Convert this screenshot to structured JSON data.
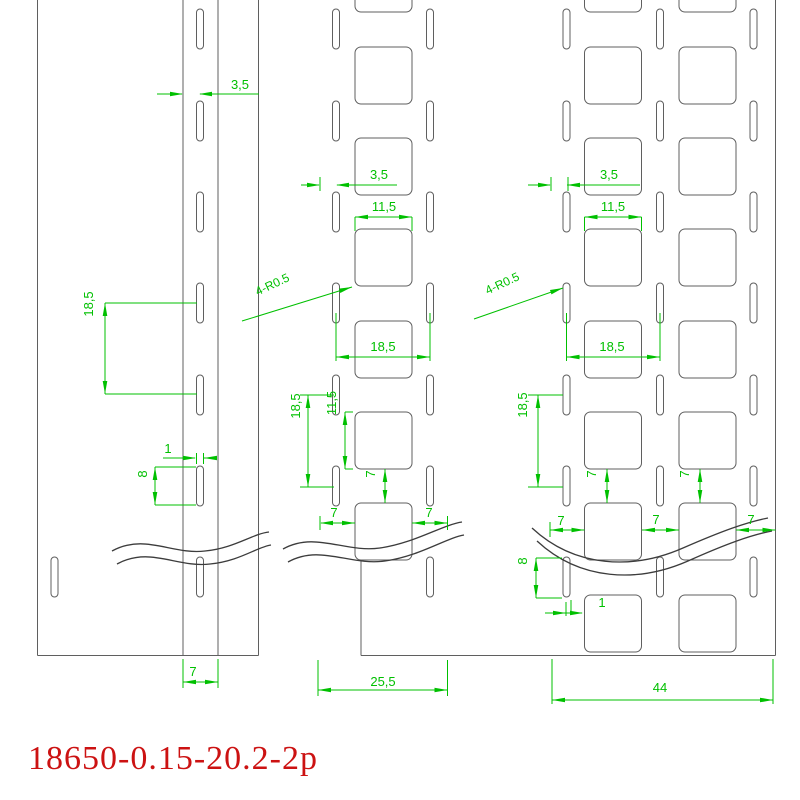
{
  "title": {
    "text": "18650-0.15-20.2-2p"
  },
  "colors": {
    "background": "#ffffff",
    "outline": "#5f5f5f",
    "wave": "#3c3c3c",
    "dimension": "#00c000",
    "title": "#cc1212"
  },
  "geometry": {
    "outline_lines": [
      [
        37.5,
        0,
        37.5,
        655.5
      ],
      [
        183,
        0,
        183,
        655.5
      ],
      [
        218,
        0,
        218,
        655.5
      ],
      [
        258.5,
        0,
        258.5,
        655.5
      ],
      [
        37.5,
        655.5,
        258.5,
        655.5
      ],
      [
        775.5,
        0,
        775.5,
        655.5
      ],
      [
        361,
        558,
        361,
        655.5
      ],
      [
        361,
        655.5,
        775.5,
        655.5
      ]
    ],
    "slot": {
      "w": 7,
      "h": 40,
      "rx": 3.5
    },
    "slot_columns": [
      {
        "x": 200,
        "centers": [
          29,
          121,
          212,
          303,
          395,
          486,
          577
        ]
      },
      {
        "x": 54.5,
        "centers": [
          577
        ]
      },
      {
        "x": 336,
        "centers": [
          29,
          121,
          212,
          303,
          395,
          486
        ]
      },
      {
        "x": 430,
        "centers": [
          29,
          121,
          212,
          303,
          395,
          486,
          577
        ]
      },
      {
        "x": 566.5,
        "centers": [
          29,
          121,
          212,
          303,
          395,
          486,
          577
        ]
      },
      {
        "x": 660,
        "centers": [
          29,
          121,
          212,
          303,
          395,
          486,
          577
        ]
      },
      {
        "x": 753.5,
        "centers": [
          29,
          121,
          212,
          303,
          395,
          486,
          577
        ]
      }
    ],
    "square": {
      "size": 57,
      "r": 6
    },
    "square_columns": [
      {
        "x": 355,
        "tops": [
          -45,
          47,
          138,
          229,
          321,
          412,
          503
        ]
      },
      {
        "x": 584.5,
        "tops": [
          -45,
          47,
          138,
          229,
          321,
          412,
          503,
          595
        ]
      },
      {
        "x": 679,
        "tops": [
          -45,
          47,
          138,
          229,
          321,
          412,
          503,
          595
        ]
      }
    ],
    "waves": [
      "M112,551 C145,533 172,555 205,551 C235,548 252,534 269,532",
      "M117,564 C150,546 177,568 210,564 C240,561 257,547 271,545",
      "M283,549 C315,531 345,553 380,548 C415,543 442,525 462,522",
      "M288,562 C320,544 350,566 385,561 C420,556 446,538 464,535",
      "M532,528 C575,568 633,570 683,548 C722,531 747,522 768,518",
      "M537,541 C580,581 638,583 688,561 C726,544 751,535 772,531"
    ]
  },
  "dimensions": {
    "lines": [
      [
        157,
        94,
        182,
        94
      ],
      [
        200,
        94,
        259,
        94
      ],
      [
        105,
        303,
        105,
        394
      ],
      [
        105,
        303,
        197,
        303
      ],
      [
        105,
        394,
        197,
        394
      ],
      [
        163,
        458,
        195,
        458
      ],
      [
        204,
        458,
        213,
        458
      ],
      [
        196.5,
        453,
        196.5,
        464
      ],
      [
        203.5,
        453,
        203.5,
        464
      ],
      [
        155,
        467,
        155,
        505
      ],
      [
        155,
        467,
        196,
        467
      ],
      [
        155,
        505,
        196,
        505
      ],
      [
        183,
        682,
        218,
        682
      ],
      [
        183,
        659,
        183,
        688
      ],
      [
        218,
        659,
        218,
        688
      ],
      [
        301,
        185,
        319,
        185
      ],
      [
        337,
        185,
        397,
        185
      ],
      [
        320,
        177,
        320,
        191
      ],
      [
        355,
        217,
        412,
        217
      ],
      [
        355,
        217,
        355,
        231
      ],
      [
        412,
        217,
        412,
        231
      ],
      [
        242,
        321,
        352,
        287
      ],
      [
        336,
        357,
        430,
        357
      ],
      [
        336,
        313,
        336,
        361
      ],
      [
        430,
        313,
        430,
        361
      ],
      [
        308,
        395,
        308,
        487
      ],
      [
        300,
        395,
        334,
        395
      ],
      [
        300,
        487,
        334,
        487
      ],
      [
        345,
        412,
        345,
        469
      ],
      [
        345,
        412,
        353,
        412
      ],
      [
        345,
        469,
        353,
        469
      ],
      [
        385,
        469,
        385,
        503
      ],
      [
        321,
        523,
        355,
        523
      ],
      [
        320,
        516,
        320,
        530
      ],
      [
        412,
        523,
        447,
        523
      ],
      [
        447.5,
        516,
        447.5,
        530
      ],
      [
        318,
        690,
        447.5,
        690
      ],
      [
        318,
        660,
        318,
        696
      ],
      [
        447.5,
        660,
        447.5,
        696
      ],
      [
        528,
        185,
        550,
        185
      ],
      [
        567,
        185,
        640,
        185
      ],
      [
        551,
        177,
        551,
        191
      ],
      [
        568,
        177,
        568,
        191
      ],
      [
        584.5,
        217,
        641.5,
        217
      ],
      [
        584.5,
        217,
        584.5,
        231
      ],
      [
        641.5,
        217,
        641.5,
        231
      ],
      [
        474,
        319,
        563,
        288
      ],
      [
        566.5,
        357,
        660,
        357
      ],
      [
        566.5,
        313,
        566.5,
        361
      ],
      [
        660,
        313,
        660,
        361
      ],
      [
        538,
        395,
        538,
        487
      ],
      [
        528,
        395,
        563,
        395
      ],
      [
        528,
        487,
        563,
        487
      ],
      [
        607,
        469,
        607,
        503
      ],
      [
        700,
        469,
        700,
        503
      ],
      [
        550,
        530,
        584.5,
        530
      ],
      [
        550,
        522,
        550,
        537
      ],
      [
        642,
        530,
        679,
        530
      ],
      [
        736,
        530,
        775.5,
        530
      ],
      [
        536,
        558,
        536,
        598
      ],
      [
        536,
        558,
        562,
        558
      ],
      [
        536,
        598,
        562,
        598
      ],
      [
        545,
        613,
        582,
        613
      ],
      [
        566,
        602,
        566,
        616
      ],
      [
        571,
        600,
        571,
        611
      ],
      [
        552,
        700,
        773,
        700
      ],
      [
        552,
        659,
        552,
        704
      ],
      [
        773,
        659,
        773,
        704
      ]
    ],
    "arrows": [
      [
        183,
        94,
        0
      ],
      [
        199,
        94,
        180
      ],
      [
        105,
        303,
        -90
      ],
      [
        105,
        394,
        90
      ],
      [
        196,
        458,
        0
      ],
      [
        204,
        458,
        180
      ],
      [
        155,
        467,
        -90
      ],
      [
        155,
        505,
        90
      ],
      [
        183,
        682,
        180
      ],
      [
        218,
        682,
        0
      ],
      [
        320,
        185,
        0
      ],
      [
        336,
        185,
        180
      ],
      [
        355,
        217,
        180
      ],
      [
        412,
        217,
        0
      ],
      [
        352,
        287,
        -17
      ],
      [
        336,
        357,
        180
      ],
      [
        430,
        357,
        0
      ],
      [
        308,
        395,
        -90
      ],
      [
        308,
        487,
        90
      ],
      [
        345,
        412,
        -90
      ],
      [
        345,
        469,
        90
      ],
      [
        385,
        469,
        -90
      ],
      [
        385,
        503,
        90
      ],
      [
        320,
        523,
        180
      ],
      [
        355,
        523,
        0
      ],
      [
        412,
        523,
        180
      ],
      [
        447.5,
        523,
        0
      ],
      [
        318,
        690,
        180
      ],
      [
        447.5,
        690,
        0
      ],
      [
        551,
        185,
        0
      ],
      [
        567,
        185,
        180
      ],
      [
        584.5,
        217,
        180
      ],
      [
        641.5,
        217,
        0
      ],
      [
        563,
        288,
        -19
      ],
      [
        566.5,
        357,
        180
      ],
      [
        660,
        357,
        0
      ],
      [
        538,
        395,
        -90
      ],
      [
        538,
        487,
        90
      ],
      [
        607,
        469,
        -90
      ],
      [
        607,
        503,
        90
      ],
      [
        700,
        469,
        -90
      ],
      [
        700,
        503,
        90
      ],
      [
        550,
        530,
        180
      ],
      [
        584.5,
        530,
        0
      ],
      [
        642,
        530,
        180
      ],
      [
        679,
        530,
        0
      ],
      [
        736,
        530,
        180
      ],
      [
        775.5,
        530,
        0
      ],
      [
        536,
        558,
        -90
      ],
      [
        536,
        598,
        90
      ],
      [
        566,
        613,
        0
      ],
      [
        583,
        613,
        0
      ],
      [
        552,
        700,
        180
      ],
      [
        773,
        700,
        0
      ]
    ],
    "labels": [
      {
        "id": "left-slot-offset",
        "text": "3,5",
        "x": 240,
        "y": 89,
        "rot": 0,
        "size": 13
      },
      {
        "id": "left-pitch",
        "text": "18,5",
        "x": 93,
        "y": 304,
        "rot": -90,
        "size": 13
      },
      {
        "id": "left-slot-width",
        "text": "1",
        "x": 168,
        "y": 453,
        "rot": 0,
        "size": 13
      },
      {
        "id": "left-slot-height",
        "text": "8",
        "x": 147,
        "y": 474,
        "rot": -90,
        "size": 13
      },
      {
        "id": "left-fold-width",
        "text": "7",
        "x": 193,
        "y": 676,
        "rot": 0,
        "size": 13
      },
      {
        "id": "mid-slot-offset",
        "text": "3,5",
        "x": 379,
        "y": 179,
        "rot": 0,
        "size": 13
      },
      {
        "id": "mid-square-width",
        "text": "11,5",
        "x": 384,
        "y": 211,
        "rot": 0,
        "size": 13
      },
      {
        "id": "mid-corner-radius",
        "text": "4-R0.5",
        "x": 274,
        "y": 288,
        "rot": -25,
        "size": 12
      },
      {
        "id": "mid-slot-pitch-h",
        "text": "18,5",
        "x": 383,
        "y": 351,
        "rot": 0,
        "size": 13
      },
      {
        "id": "mid-pitch-v",
        "text": "18,5",
        "x": 300,
        "y": 406,
        "rot": -90,
        "size": 13
      },
      {
        "id": "mid-square-height",
        "text": "11,5",
        "x": 336,
        "y": 403,
        "rot": -90,
        "size": 13
      },
      {
        "id": "mid-square-gap",
        "text": "7",
        "x": 375,
        "y": 474,
        "rot": -90,
        "size": 13
      },
      {
        "id": "mid-margin-left",
        "text": "7",
        "x": 334,
        "y": 517,
        "rot": 0,
        "size": 13
      },
      {
        "id": "mid-margin-right",
        "text": "7",
        "x": 429,
        "y": 517,
        "rot": 0,
        "size": 13
      },
      {
        "id": "mid-strip-width",
        "text": "25,5",
        "x": 383,
        "y": 686,
        "rot": 0,
        "size": 13
      },
      {
        "id": "right-slot-offset",
        "text": "3,5",
        "x": 609,
        "y": 179,
        "rot": 0,
        "size": 13
      },
      {
        "id": "right-square-width",
        "text": "11,5",
        "x": 613,
        "y": 211,
        "rot": 0,
        "size": 13
      },
      {
        "id": "right-corner-radius",
        "text": "4-R0.5",
        "x": 504,
        "y": 287,
        "rot": -25,
        "size": 12
      },
      {
        "id": "right-slot-pitch-h",
        "text": "18,5",
        "x": 612,
        "y": 351,
        "rot": 0,
        "size": 13
      },
      {
        "id": "right-pitch-v",
        "text": "18,5",
        "x": 527,
        "y": 405,
        "rot": -90,
        "size": 13
      },
      {
        "id": "right-square-gap-1",
        "text": "7",
        "x": 596,
        "y": 474,
        "rot": -90,
        "size": 13
      },
      {
        "id": "right-square-gap-2",
        "text": "7",
        "x": 689,
        "y": 474,
        "rot": -90,
        "size": 13
      },
      {
        "id": "right-margin-1",
        "text": "7",
        "x": 561,
        "y": 525,
        "rot": 0,
        "size": 13
      },
      {
        "id": "right-margin-2",
        "text": "7",
        "x": 656,
        "y": 524,
        "rot": 0,
        "size": 13
      },
      {
        "id": "right-margin-3",
        "text": "7",
        "x": 751,
        "y": 524,
        "rot": 0,
        "size": 13
      },
      {
        "id": "right-slot-height",
        "text": "8",
        "x": 527,
        "y": 561,
        "rot": -90,
        "size": 13
      },
      {
        "id": "right-slot-gap",
        "text": "1",
        "x": 602,
        "y": 607,
        "rot": 0,
        "size": 13
      },
      {
        "id": "right-strip-width",
        "text": "44",
        "x": 660,
        "y": 692,
        "rot": 0,
        "size": 13
      }
    ]
  }
}
